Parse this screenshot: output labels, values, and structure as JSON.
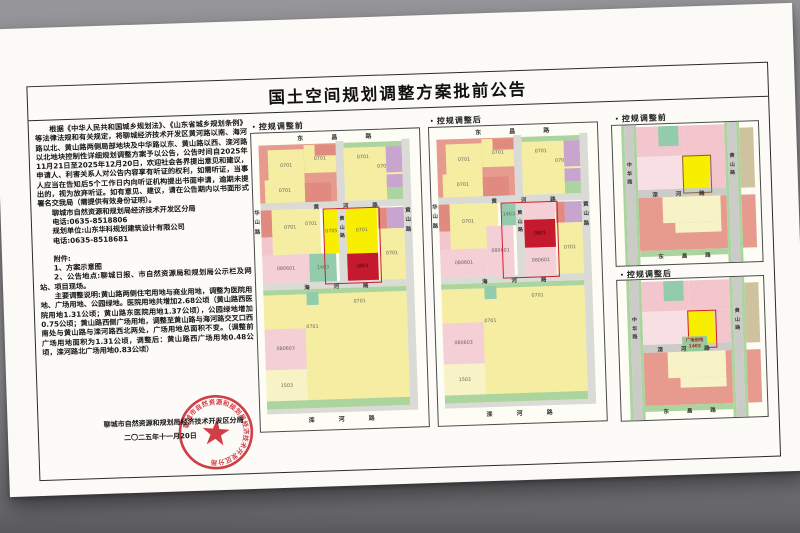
{
  "notice": {
    "title": "国土空间规划调整方案批前公告",
    "para1": "根据《中华人民共和国城乡规划法》、《山东省城乡规划条例》等法律法规和有关规定，将聊城经济技术开发区黄河路以南、海河路以北、黄山路两侧局部地块及中华路以东、黄山路以西、滦河路以北地块控制性详细规划调整方案予以公告，公告时间自2025年11月21日至2025年12月20日，欢迎社会各界提出意见和建议，申请人、利害关系人对公告内容享有听证的权利，如需听证，当事人应当在告知后5个工作日内向听证机构提出书面申请，逾期未提出的，视为放弃听证。如有意见、建议，请在公告期内以书面形式署名交我局（需提供有效身份证明）。",
    "agency": "聊城市自然资源和规划局经济技术开发区分局",
    "phone1": "电话:0635-8518806",
    "planner": "规划单位:山东华科规划建筑设计有限公司",
    "phone2": "电话:0635-8518681",
    "attach_head": "附件:",
    "attach1": "1、方案示意图",
    "attach2": "2、公告地点:聊城日报、市自然资源局和规划局公示栏及网站、项目现场。",
    "note": "主要调整说明:黄山路两侧住宅用地与商业用地，调整为医院用地、广场用地、公园绿地。医院用地共增加2.68公顷（黄山路西医院用地1.31公顷；黄山路东医院用地1.37公顷），公园绿地增加0.75公顷；黄山路西侧广场用地，调整至黄山路与海河路交叉口西南处与黄山路与滦河路西北两处，广场用地总面积不变。（调整前广场用地面积为1.31公顷，调整后：黄山路西广场用地0.48公顷，滦河路北广场用地0.83公顷）",
    "signature": "聊城市自然资源和规划局经济技术开发区分局",
    "date": "二〇二五年十一月20日",
    "stamp_text": "聊城市自然资源和规划局经济技术开发区分局"
  },
  "panels": {
    "before_big": "・控规调整前",
    "after_big": "・控规调整后",
    "before_small": "・控规调整前",
    "after_small": "・控规调整后"
  },
  "maps": {
    "colors": {
      "road": "#dadad6",
      "roadS": "#cbcbc7",
      "salmon": "#e79a8e",
      "salmon2": "#e08a80",
      "pink": "#f3c6ce",
      "pinkL": "#f4cfd6",
      "pinkPale": "#f7dfe4",
      "yellow": "#f4eda2",
      "yellowHL": "#f8ef00",
      "paleY": "#f8f3c6",
      "redHL": "#c5192e",
      "teal": "#93ccac",
      "green": "#abd49f",
      "purple": "#c8a5cf",
      "tan": "#cfc29f",
      "labelGreen": "#98cb9b"
    },
    "big": {
      "w": 168,
      "h": 298,
      "base_blocks": [
        [
          84,
          10,
          8,
          266,
          "road"
        ],
        [
          150,
          10,
          8,
          266,
          "road"
        ],
        [
          7,
          70,
          151,
          7,
          "road"
        ],
        [
          7,
          150,
          151,
          7,
          "road"
        ],
        [
          7,
          274,
          151,
          7,
          "road"
        ],
        [
          7,
          12,
          77,
          58,
          "salmon"
        ],
        [
          16,
          17,
          36,
          32,
          "yellow",
          "0701"
        ],
        [
          52,
          13,
          32,
          28,
          "yellow",
          "0701"
        ],
        [
          12,
          47,
          40,
          23,
          "yellow",
          "0701"
        ],
        [
          52,
          51,
          26,
          19,
          "salmon2"
        ],
        [
          63,
          13,
          21,
          11,
          "salmon2"
        ],
        [
          92,
          12,
          58,
          58,
          "yellow"
        ],
        [
          92,
          12,
          58,
          5,
          "green"
        ],
        [
          96,
          22,
          30,
          10,
          "none",
          "0701"
        ],
        [
          118,
          32,
          26,
          10,
          "none",
          "0701"
        ],
        [
          134,
          17,
          16,
          26,
          "purple"
        ],
        [
          134,
          45,
          16,
          13,
          "purple"
        ],
        [
          134,
          58,
          16,
          12,
          "green"
        ],
        [
          7,
          157,
          143,
          119,
          "yellow"
        ],
        [
          7,
          157,
          143,
          5,
          "green"
        ],
        [
          50,
          160,
          12,
          13,
          "teal"
        ],
        [
          88,
          166,
          30,
          10,
          "none",
          "0701"
        ],
        [
          40,
          190,
          30,
          10,
          "none",
          "0701"
        ],
        [
          7,
          196,
          41,
          41,
          "pinkL",
          "080603"
        ],
        [
          7,
          237,
          41,
          32,
          "paleY",
          "1503"
        ],
        [
          7,
          268,
          143,
          8,
          "green"
        ]
      ],
      "before_blocks": [
        [
          7,
          77,
          11,
          27,
          "salmon2"
        ],
        [
          7,
          104,
          11,
          20,
          "pink"
        ],
        [
          18,
          77,
          48,
          45,
          "yellow"
        ],
        [
          24,
          90,
          24,
          10,
          "none",
          "0701"
        ],
        [
          46,
          87,
          22,
          10,
          "none",
          "0701"
        ],
        [
          7,
          122,
          47,
          28,
          "pinkL",
          "080601"
        ],
        [
          54,
          122,
          27,
          28,
          "teal",
          "1403"
        ],
        [
          70,
          78,
          14,
          44,
          "yellowHL",
          "0705"
        ],
        [
          92,
          78,
          31,
          45,
          "yellowHL",
          "0701"
        ],
        [
          92,
          123,
          31,
          27,
          "redHL",
          "0801"
        ],
        [
          124,
          78,
          9,
          21,
          "salmon2"
        ],
        [
          133,
          78,
          17,
          21,
          "purple"
        ],
        [
          124,
          99,
          26,
          51,
          "yellow",
          "0701"
        ]
      ],
      "after_blocks": [
        [
          7,
          77,
          11,
          27,
          "salmon2"
        ],
        [
          7,
          104,
          11,
          20,
          "pink"
        ],
        [
          18,
          77,
          48,
          45,
          "yellow"
        ],
        [
          24,
          90,
          24,
          10,
          "none",
          "0701"
        ],
        [
          7,
          122,
          47,
          28,
          "pinkL",
          "080601"
        ],
        [
          54,
          100,
          27,
          50,
          "pinkL",
          "080601"
        ],
        [
          70,
          78,
          14,
          22,
          "teal",
          "1403"
        ],
        [
          92,
          78,
          31,
          17,
          "pinkL"
        ],
        [
          92,
          95,
          31,
          28,
          "redHL",
          "0801"
        ],
        [
          92,
          123,
          31,
          27,
          "pinkL",
          "080601"
        ],
        [
          124,
          78,
          9,
          21,
          "salmon2"
        ],
        [
          133,
          78,
          17,
          21,
          "purple"
        ],
        [
          124,
          99,
          26,
          51,
          "yellow",
          "0701"
        ]
      ],
      "outline": [
        69,
        77,
        55,
        74
      ],
      "texts": [
        {
          "t": "东 昌 路",
          "x": 46,
          "y": 1,
          "fs": 6,
          "ls": 13
        },
        {
          "t": "黄 河 路",
          "x": 60,
          "y": 70.5,
          "fs": 5.5,
          "ls": 11
        },
        {
          "t": "海 河 路",
          "x": 48,
          "y": 150.5,
          "fs": 5.5,
          "ls": 11
        },
        {
          "t": "滦 河 路",
          "x": 48,
          "y": 283,
          "fs": 6,
          "ls": 11
        },
        {
          "t": "华山路",
          "x": 0.5,
          "y": 76,
          "fs": 5.5,
          "v": 1
        },
        {
          "t": "黄山路",
          "x": 85.5,
          "y": 84,
          "fs": 5,
          "v": 1
        },
        {
          "t": "黄山路",
          "x": 151.5,
          "y": 78,
          "fs": 5.5,
          "v": 1
        }
      ]
    },
    "small": {
      "w": 146,
      "h": 140,
      "blocks": [
        [
          9,
          0,
          3,
          140,
          "green"
        ],
        [
          21,
          0,
          3,
          140,
          "green"
        ],
        [
          12,
          0,
          9,
          140,
          "roadS"
        ],
        [
          112,
          0,
          3,
          140,
          "green"
        ],
        [
          124,
          0,
          3,
          140,
          "green"
        ],
        [
          115,
          0,
          9,
          140,
          "roadS"
        ],
        [
          24,
          2,
          47,
          30,
          "pink"
        ],
        [
          46,
          2,
          20,
          20,
          "teal"
        ],
        [
          71,
          2,
          41,
          30,
          "pink"
        ],
        [
          24,
          32,
          45,
          33,
          "pinkPale"
        ],
        [
          69,
          32,
          27,
          36,
          "yellowHL"
        ],
        [
          96,
          32,
          16,
          33,
          "pink"
        ],
        [
          24,
          65,
          88,
          8,
          "roadS"
        ],
        [
          24,
          73,
          88,
          53,
          "salmon"
        ],
        [
          48,
          73,
          58,
          26,
          "paleY"
        ],
        [
          60,
          99,
          46,
          10,
          "paleY"
        ],
        [
          127,
          6,
          14,
          60,
          "tan"
        ],
        [
          127,
          73,
          14,
          53,
          "salmon"
        ],
        [
          24,
          126,
          88,
          6,
          "green"
        ]
      ],
      "highlight_rect": [
        69,
        32,
        27,
        36
      ],
      "before_outline_color": "#8a6030",
      "after_outline_color": "#cf2030",
      "after_label": {
        "rect": [
          63,
          58,
          25,
          15
        ],
        "bg": "#98cb9b",
        "line1": "广场用地",
        "line2": "1403",
        "text_color": "#b02020"
      },
      "texts": [
        {
          "t": "滦 河 路",
          "x": 38,
          "y": 66,
          "fs": 5.5,
          "ls": 8
        },
        {
          "t": "东 昌 路",
          "x": 42,
          "y": 127.5,
          "fs": 5.5,
          "ls": 8
        },
        {
          "t": "中华路",
          "x": 13.5,
          "y": 36,
          "fs": 5,
          "v": 1
        },
        {
          "t": "黄山路",
          "x": 116.5,
          "y": 30,
          "fs": 5,
          "v": 1
        }
      ]
    }
  }
}
